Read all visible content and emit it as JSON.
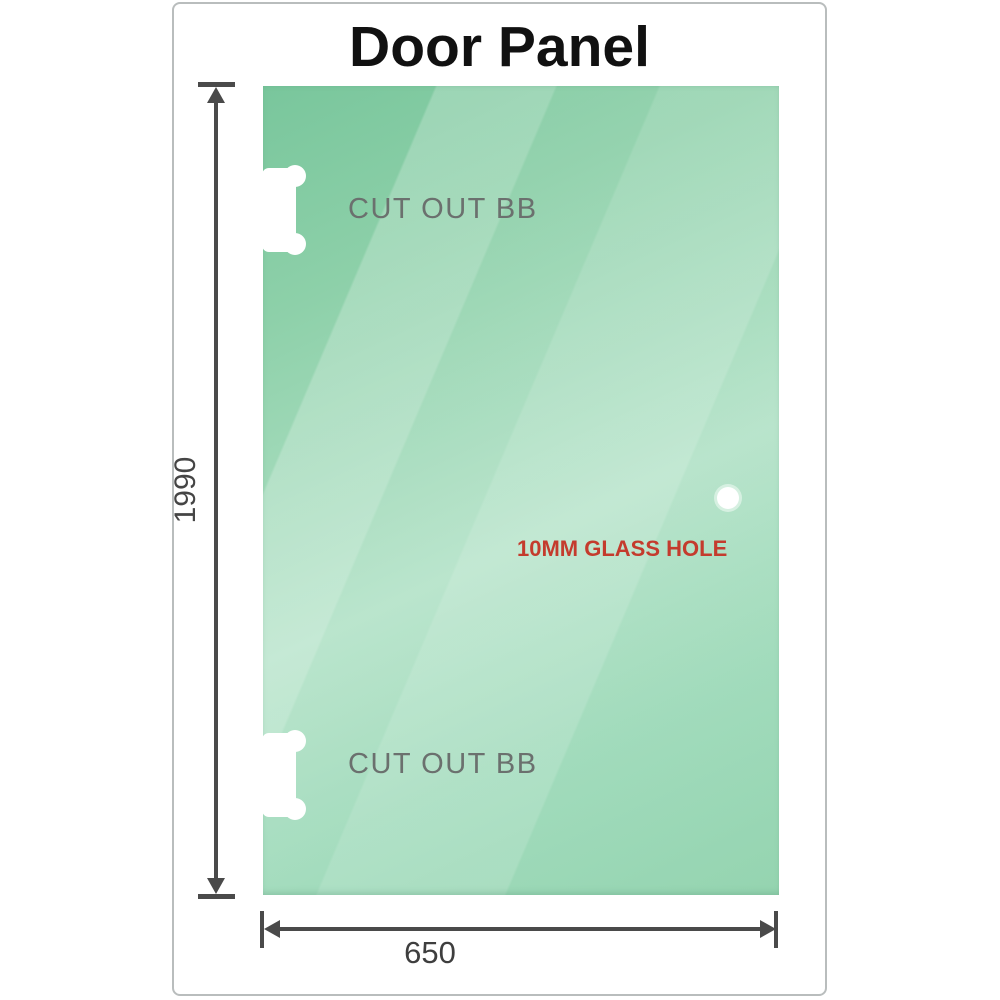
{
  "title": "Door Panel",
  "dimensions": {
    "height": {
      "value": "1990"
    },
    "width": {
      "value": "650"
    }
  },
  "annotations": {
    "cutout_top": "CUT OUT BB",
    "cutout_bottom": "CUT OUT BB",
    "glass_hole": "10MM GLASS HOLE"
  },
  "colors": {
    "glass_dark": "#79c69c",
    "glass_mid": "#8fd2ac",
    "glass_light": "#b5e3c9",
    "dimension": "#4a4a4a",
    "cutout_text": "#6b706e",
    "hole_text": "#c43b2d",
    "frame_border": "#b9bdbd",
    "title_text": "#111111"
  }
}
